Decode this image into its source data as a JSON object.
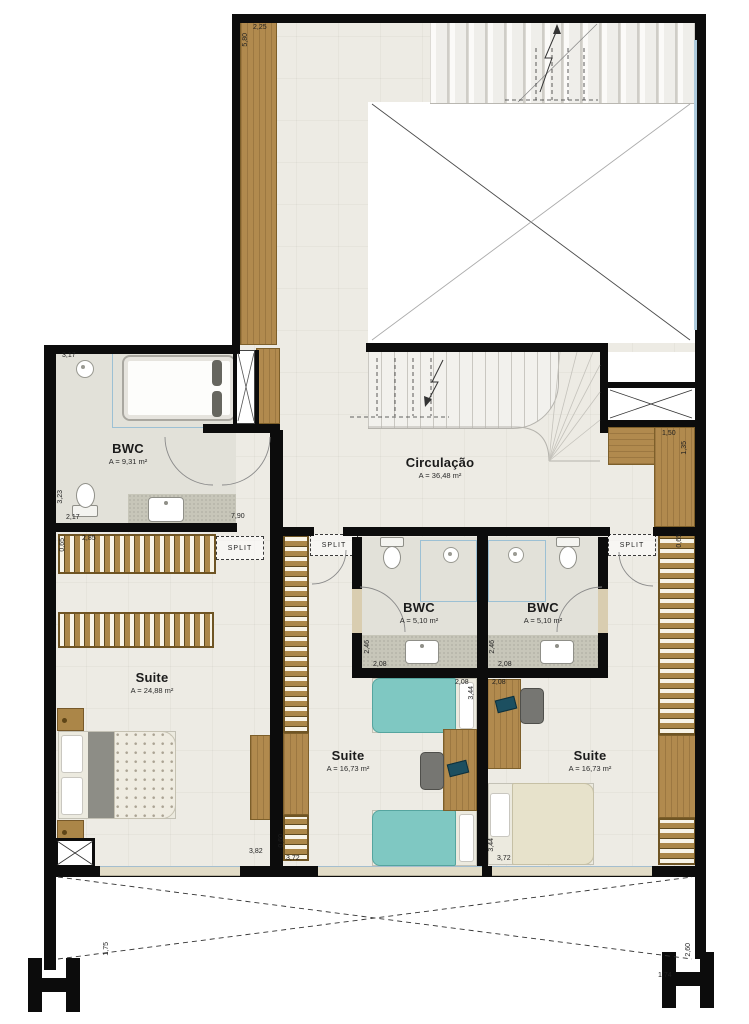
{
  "rooms": {
    "bwc_left": {
      "name": "BWC",
      "area": "A = 9,31 m²"
    },
    "circulacao": {
      "name": "Circulação",
      "area": "A = 36,48 m²"
    },
    "bwc_a": {
      "name": "BWC",
      "area": "A = 5,10 m²"
    },
    "bwc_b": {
      "name": "BWC",
      "area": "A = 5,10 m²"
    },
    "suite_left": {
      "name": "Suite",
      "area": "A = 24,88 m²"
    },
    "suite_mid": {
      "name": "Suite",
      "area": "A = 16,73 m²"
    },
    "suite_right": {
      "name": "Suite",
      "area": "A = 16,73 m²"
    }
  },
  "equipment": {
    "split_label": "SPLIT"
  },
  "dimensions": {
    "corridor_width": "2,25",
    "corridor_length": "5,80",
    "bwc_left_top": "3,17",
    "bwc_left_height": "3,23",
    "bwc_left_vanity": "2,17",
    "corridor_total": "7,90",
    "closet_width": "1,50",
    "closet_depth": "1,35",
    "wardrobe_left_width": "2,85",
    "wardrobe_left_depth": "0,65",
    "bwc_a_height": "2,46",
    "bwc_a_width": "2,08",
    "bwc_b_height": "2,46",
    "bwc_b_width": "2,08",
    "suite_mid_bed": "2,08",
    "suite_mid_height": "3,44",
    "suite_right_top": "2,08",
    "suite_left_width": "3,82",
    "wardrobe_mid_depth": "0,60",
    "suite_mid_width": "3,72",
    "suite_right_height": "3,44",
    "suite_right_width": "3,72",
    "wardrobe_right_depth": "0,65",
    "column_left": "1,75",
    "column_right_v": "2,60",
    "column_right_h": "1,74"
  }
}
